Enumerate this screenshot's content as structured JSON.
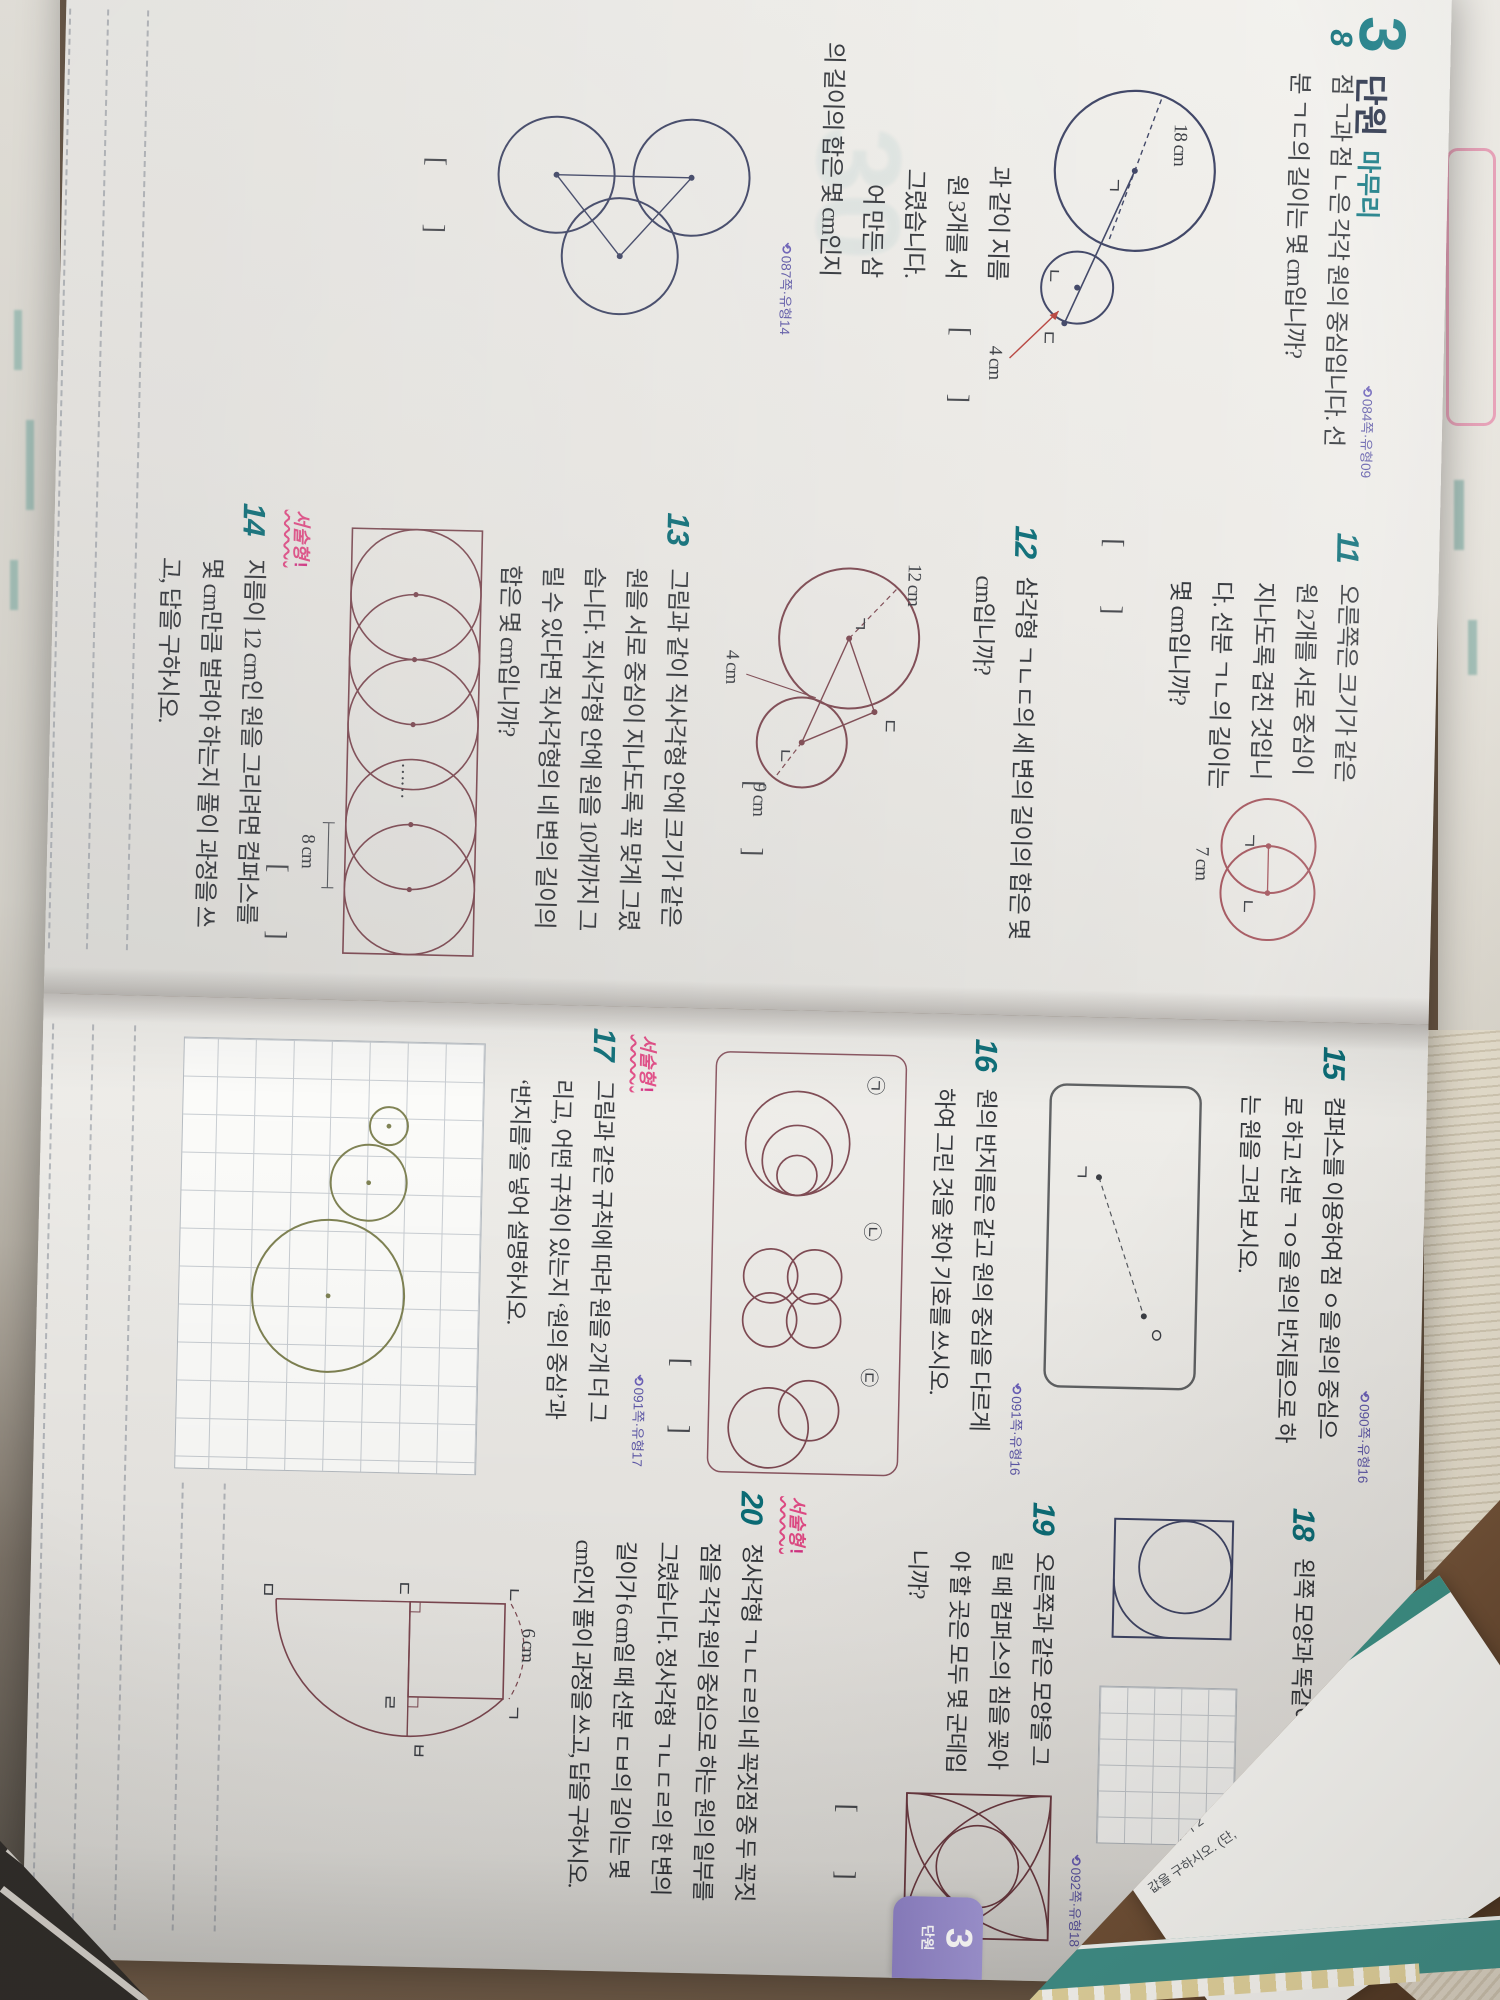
{
  "ref_icon": "⟲",
  "answer_icon": "◉",
  "bracket": {
    "open": "[",
    "close": "]"
  },
  "badge_label": "서술형",
  "left": {
    "header": {
      "num": "3",
      "t1": "단원",
      "t2": "마무리"
    },
    "p8": {
      "num": "8",
      "tag": "084쪽·유형09",
      "l1": "점 ㄱ과 점 ㄴ은 각각 원의 중심입니다. 선",
      "l2": "분 ㄱㄷ의 길이는 몇 cm입니까?",
      "fig": {
        "pA": "ㄱ",
        "pB": "ㄴ",
        "pC": "ㄷ",
        "r_big": "18 cm",
        "r_small": "4 cm"
      }
    },
    "p10": {
      "tag": "087쪽·유형14",
      "f1": "과 같이 지름",
      "f2": "원 3개를 서",
      "f3": "그렸습니다.",
      "f4": "어 만든 삼",
      "f5": "의 길이의 합은 몇 cm인지"
    },
    "p11": {
      "num": "11",
      "l1": "오른쪽은 크기가 같은",
      "l2": "원 2개를 서로 중심이",
      "l3": "지나도록 겹친 것입니",
      "l4": "다. 선분 ㄱㄴ의 길이는",
      "l5": "몇 cm입니까?",
      "fig": {
        "pA": "ㄱ",
        "pB": "ㄴ",
        "len": "7 cm"
      }
    },
    "p12": {
      "num": "12",
      "l1": "삼각형 ㄱㄴㄷ의 세 변의 길이의 합은 몇",
      "l2": "cm입니까?",
      "fig": {
        "pA": "ㄱ",
        "pB": "ㄴ",
        "pC": "ㄷ",
        "rA": "12 cm",
        "rB": "9 cm",
        "gap": "4 cm"
      }
    },
    "p13": {
      "num": "13",
      "l1": "그림과 같이 직사각형 안에 크기가 같은",
      "l2": "원을 서로 중심이 지나도록 꼭 맞게 그렸",
      "l3": "습니다. 직사각형 안에 원을 10개까지 그",
      "l4": "릴 수 있다면 직사각형의 네 변의 길이의",
      "l5": "합은 몇 cm입니까?",
      "fig": {
        "dots": "……",
        "len": "8 cm"
      }
    },
    "p14": {
      "num": "14",
      "l1": "지름이 12 cm인 원을 그리려면 컴퍼스를",
      "l2": "몇 cm만큼 벌려야 하는지 풀이 과정을 쓰",
      "l3": "고, 답을 구하시오."
    }
  },
  "right": {
    "note": "빠른 정답 06쪽, 자세한 풀이 44쪽",
    "p15": {
      "num": "15",
      "tag": "090쪽·유형16",
      "l1": "컴퍼스를 이용하여 점 ㅇ을 원의 중심으",
      "l2": "로 하고 선분 ㄱㅇ을 원의 반지름으로 하",
      "l3": "는 원을 그려 보시오.",
      "fig": {
        "pA": "ㄱ",
        "pB": "ㅇ"
      }
    },
    "p16": {
      "num": "16",
      "tag": "091쪽·유형16",
      "l1": "원의 반지름은 같고 원의 중심을 다르게",
      "l2": "하여 그린 것을 찾아 기호를 쓰시오.",
      "fig": {
        "g1": "㉠",
        "g2": "㉡",
        "g3": "㉢"
      }
    },
    "p17": {
      "num": "17",
      "tag": "091쪽·유형17",
      "l1": "그림과 같은 규칙에 따라 원을 2개 더 그",
      "l2": "리고, 어떤 규칙이 있는지 ‘원의 중심’과",
      "l3": "‘반지름’을 넣어 설명하시오."
    },
    "p18": {
      "num": "18",
      "tag": "092쪽·유형18",
      "l1": "왼쪽 모양과 똑같이 그려 보시오."
    },
    "p19": {
      "num": "19",
      "tag": "092쪽·유형18",
      "l1": "오른쪽과 같은 모양을 그",
      "l2": "릴 때 컴퍼스의 침을 꽂아",
      "l3": "야 할 곳은 모두 몇 군데입",
      "l4": "니까?"
    },
    "p20": {
      "num": "20",
      "l1": "정사각형 ㄱㄴㄷㄹ의 네 꼭짓점 중 두 꼭짓",
      "l2": "점을 각각 원의 중심으로 하는 원의 일부를",
      "l3": "그렸습니다. 정사각형 ㄱㄴㄷㄹ의 한 변의",
      "l4": "길이가 6 cm일 때 선분 ㄷㅂ의 길이는 몇",
      "l5": "cm인지 풀이 과정을 쓰고, 답을 구하시오.",
      "fig": {
        "pA": "ㄱ",
        "pB": "ㄴ",
        "pC": "ㄷ",
        "pD": "ㄹ",
        "pE": "ㅁ",
        "pF": "ㅂ",
        "len": "6 cm"
      }
    },
    "tab": {
      "num": "3",
      "label": "단원"
    }
  },
  "props": {
    "m1": "2⁵×3³×5³×11일 때,",
    "m2": "최대공약수가 2",
    "m3": "값을 구하시오. (단,"
  }
}
